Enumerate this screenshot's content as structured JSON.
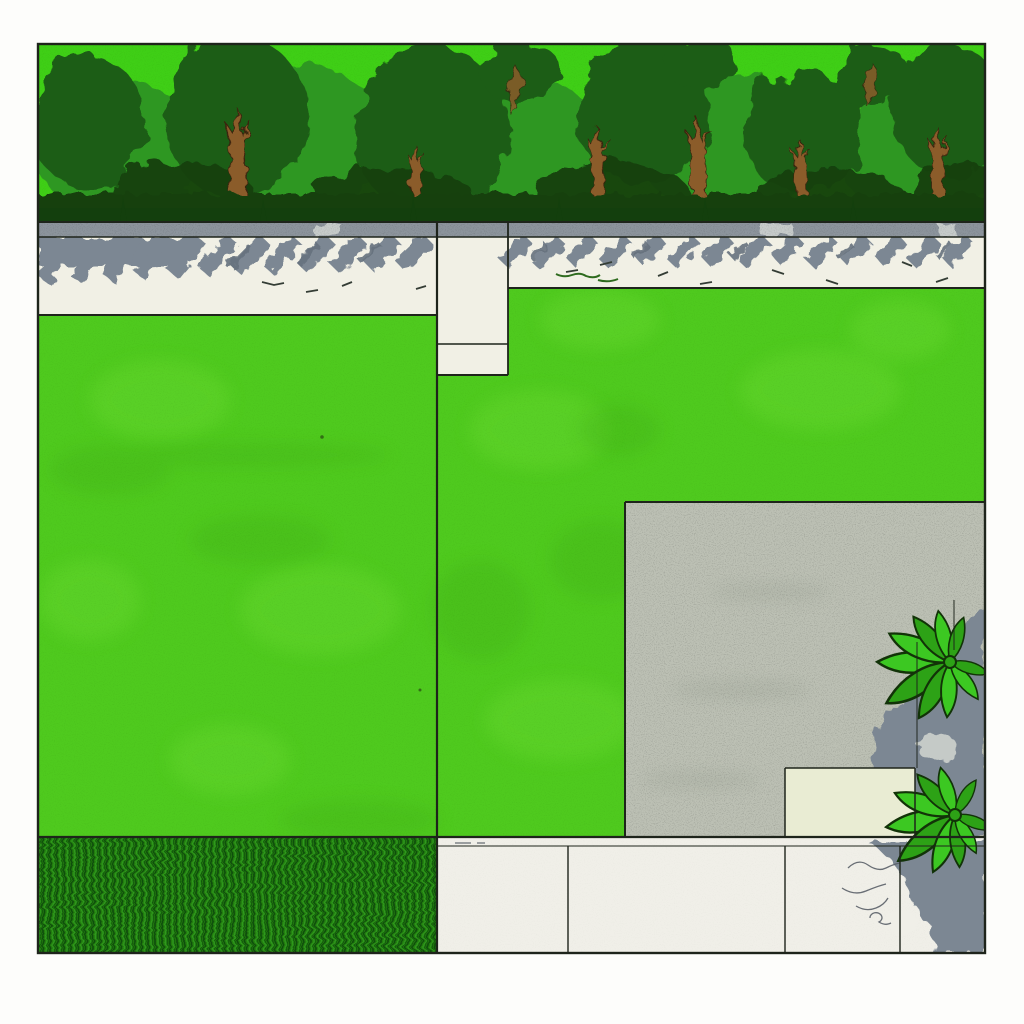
{
  "scene": {
    "title": "garden-plan-illustration",
    "style": "ink-and-watercolor plan view of a garden",
    "canvas": {
      "width": 1024,
      "height": 1024
    },
    "drawing_bounds": {
      "x": 38,
      "y": 44,
      "width": 947,
      "height": 909
    },
    "palette": {
      "page_bg": "#fdfdfb",
      "ink": "#1e241b",
      "tree_light": "#3fcf16",
      "tree_mid": "#2f9721",
      "tree_dark": "#1d5d15",
      "tree_deep": "#133f0d",
      "trunk": "#8b5c2b",
      "curb": "#8c949c",
      "curb_gap": "#cdd2cf",
      "path": "#f1f0e5",
      "shadow": "#7c8793",
      "shadow_dark": "#66727e",
      "shadow_notch": "#c9cec9",
      "lawn": "#4fca1e",
      "lawn_light": "#6ada30",
      "lawn_shade": "#3fae17",
      "patio": "#bcc0b4",
      "patio_smudge": "#a7ada0",
      "beige": "#e9ecd3",
      "grass_base": "#1d6f0e",
      "grass_dark": "#227d11",
      "grass_mid": "#2f9a1c",
      "grass_line": "#0f4d07",
      "paving": "#f0efe8",
      "leaf": "#3cc822",
      "leaf_dark": "#2da216",
      "leaf_ink": "#123308",
      "pencil": "#5a6068",
      "ink_tick": "#343d35",
      "green_scribble": "#2e6b1e"
    },
    "regions": [
      {
        "name": "tree-hedge",
        "x": 38,
        "y": 44,
        "w": 947,
        "h": 178
      },
      {
        "name": "curb-strip",
        "x": 38,
        "y": 222,
        "w": 947,
        "h": 15
      },
      {
        "name": "path-left",
        "x": 38,
        "y": 237,
        "w": 399,
        "h": 78
      },
      {
        "name": "path-alcove",
        "x": 437,
        "y": 237,
        "w": 71,
        "h": 138,
        "joint_y": 344
      },
      {
        "name": "path-right",
        "x": 508,
        "y": 237,
        "w": 477,
        "h": 51
      },
      {
        "name": "lawn-left",
        "x": 38,
        "y": 315,
        "w": 399,
        "h": 522
      },
      {
        "name": "lawn-right",
        "x": 437,
        "y": 288,
        "w": 548,
        "h": 549,
        "patio_cutout": true
      },
      {
        "name": "lawn-seam-x",
        "x": 437
      },
      {
        "name": "patio",
        "x": 625,
        "y": 502,
        "w": 360,
        "h": 335
      },
      {
        "name": "planter-pad",
        "x": 785,
        "y": 768,
        "w": 130,
        "h": 69
      },
      {
        "name": "shrub-upper",
        "cx": 950,
        "cy": 662
      },
      {
        "name": "shrub-lower",
        "cx": 955,
        "cy": 815
      },
      {
        "name": "tall-grass-strip",
        "x": 38,
        "y": 837,
        "w": 399,
        "h": 116
      },
      {
        "name": "paving-strip",
        "x": 437,
        "y": 837,
        "w": 548,
        "h": 116,
        "joints_x": [
          568,
          785,
          900
        ]
      }
    ]
  }
}
